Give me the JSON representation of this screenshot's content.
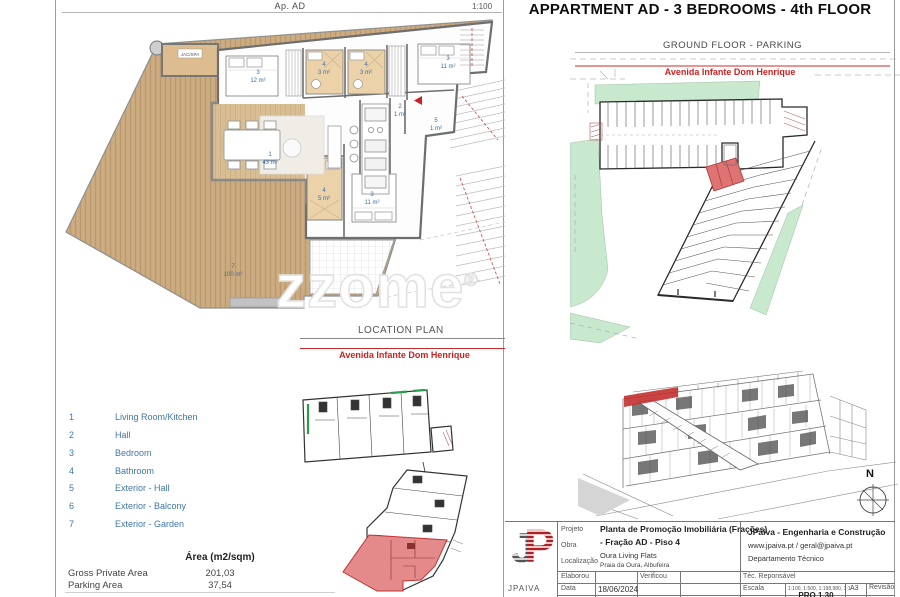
{
  "sheet": {
    "title": "APPARTMENT AD - 3 BEDROOMS - 4th FLOOR",
    "plan_header": "Ap. AD",
    "plan_scale": "1:100",
    "watermark": "zzome",
    "watermark_reg": "®"
  },
  "parking": {
    "header": "GROUND FLOOR - PARKING",
    "street": "Avenida Infante Dom Henrique"
  },
  "location_plan": {
    "header": "LOCATION PLAN",
    "street": "Avenida Infante Dom Henrique"
  },
  "compass": {
    "north": "N"
  },
  "floor_plan": {
    "jacuzzi_label": "JAC/SPA",
    "labels": [
      {
        "num": "3",
        "area": "12 m²"
      },
      {
        "num": "4",
        "area": "3 m²"
      },
      {
        "num": "4",
        "area": "3 m²"
      },
      {
        "num": "2",
        "area": "1 m²"
      },
      {
        "num": "3",
        "area": "11 m²"
      },
      {
        "num": "5",
        "area": "1 m²"
      },
      {
        "num": "1",
        "area": "43 m²"
      },
      {
        "num": "4",
        "area": "5 m²"
      },
      {
        "num": "3",
        "area": "11 m²"
      },
      {
        "num": "7",
        "area": "100 m²"
      }
    ]
  },
  "legend": {
    "items": [
      {
        "num": "1",
        "label": "Living Room/Kitchen"
      },
      {
        "num": "2",
        "label": "Hall"
      },
      {
        "num": "3",
        "label": "Bedroom"
      },
      {
        "num": "4",
        "label": "Bathroom"
      },
      {
        "num": "5",
        "label": "Exterior - Hall"
      },
      {
        "num": "6",
        "label": "Exterior - Balcony"
      },
      {
        "num": "7",
        "label": "Exterior - Garden"
      }
    ]
  },
  "areas": {
    "header": "Área (m2/sqm)",
    "rows": [
      {
        "label": "Gross Private Area",
        "value": "201,03"
      },
      {
        "label": "Parking Area",
        "value": "37,54"
      }
    ]
  },
  "title_block": {
    "logo_letters": "JP",
    "company_short": "JPAIVA",
    "projeto_label": "Projeto",
    "obra_label": "Obra",
    "localizacao_label": "Localização",
    "project_line1": "Planta de Promoção Imobiliária (Frações)",
    "project_line2": "- Fração AD - Piso 4",
    "obra_value": "Oura Living Flats",
    "localizacao_value": "Praia da Oura, Albufeira",
    "company": "JPaiva - Engenharia e Construção",
    "contacts": "www.jpaiva.pt / geral@jpaiva.pt",
    "department": "Departamento Técnico",
    "elaborou_label": "Elaborou",
    "verificou_label": "Verificou",
    "tec_label": "Téc. Reponsável",
    "data_label": "Data",
    "data_value": "18/06/2024",
    "escala_label": "Escala",
    "escala_value": "1:100, 1:500, 1:198,980, 1:1",
    "sheet_size": "A3",
    "doc_number": "PRO 1.30",
    "revisao_label": "Revisão"
  }
}
